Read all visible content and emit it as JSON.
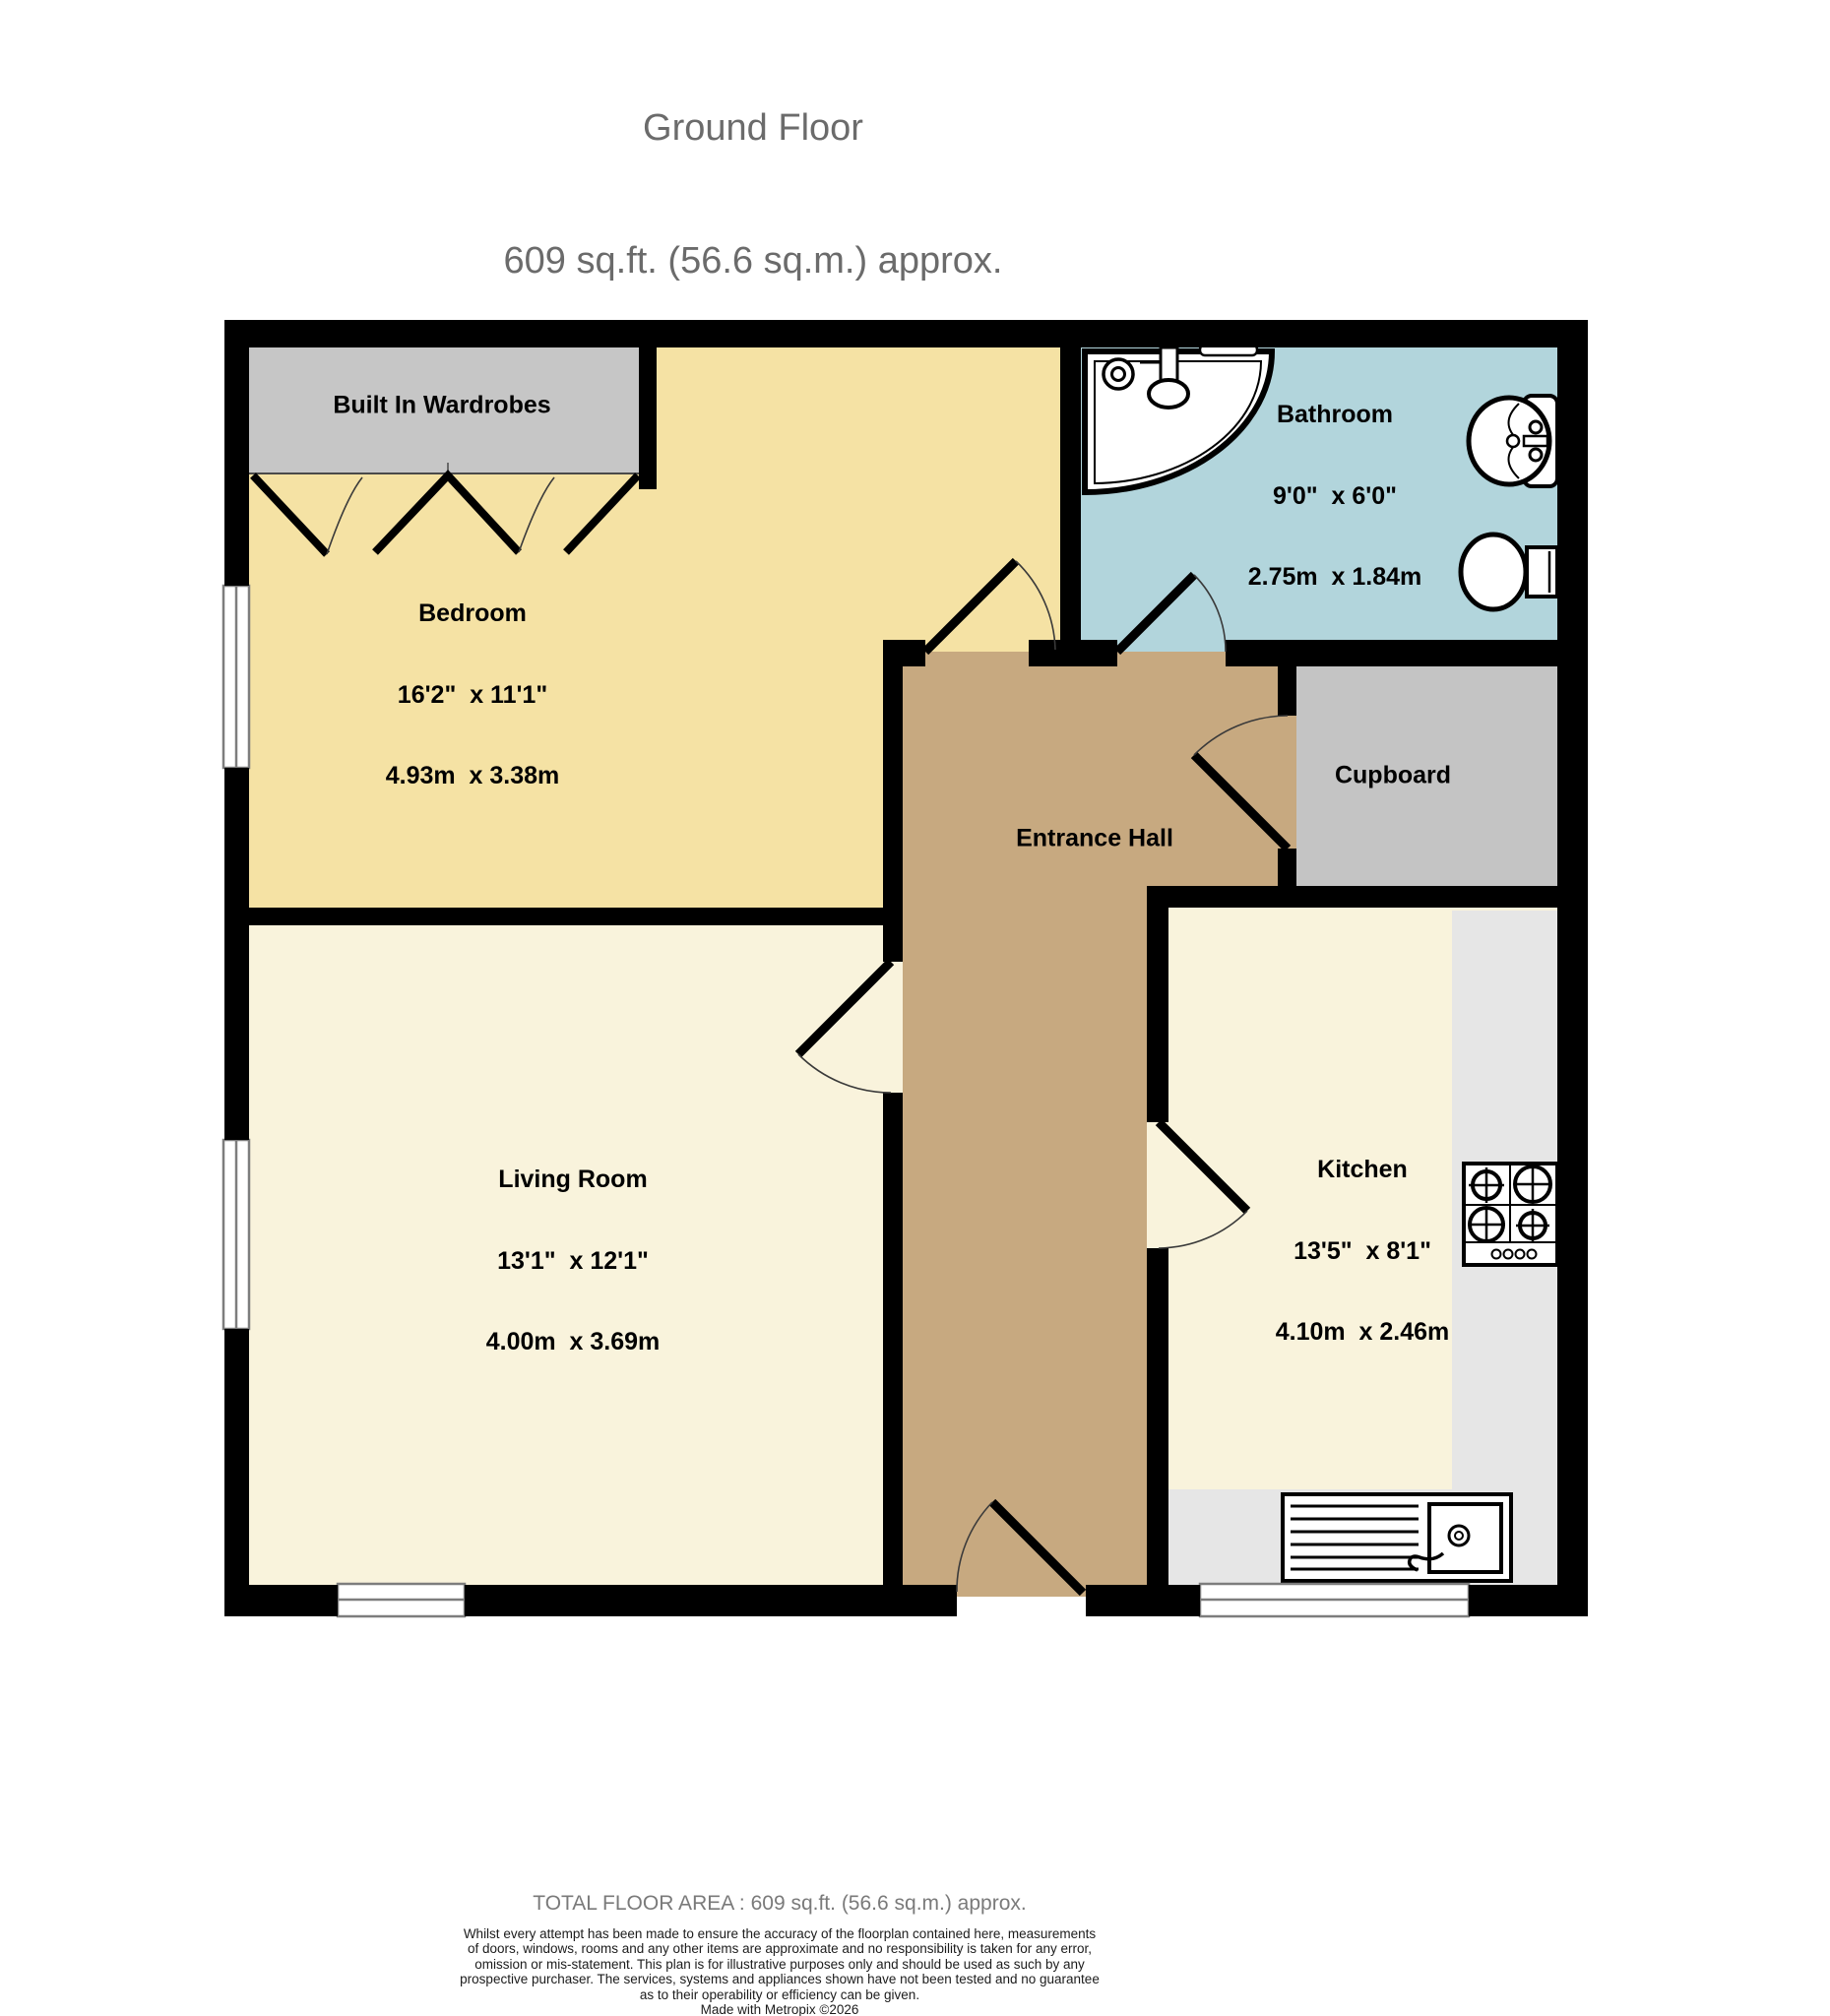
{
  "title": {
    "line1": "Ground Floor",
    "line2": "609 sq.ft. (56.6 sq.m.) approx."
  },
  "rooms": {
    "wardrobe": {
      "name": "Built In Wardrobes"
    },
    "bedroom": {
      "name": "Bedroom",
      "dims_ft": "16'2\"  x 11'1\"",
      "dims_m": "4.93m  x 3.38m"
    },
    "bathroom": {
      "name": "Bathroom",
      "dims_ft": "9'0\"  x 6'0\"",
      "dims_m": "2.75m  x 1.84m"
    },
    "cupboard": {
      "name": "Cupboard"
    },
    "entrance_hall": {
      "name": "Entrance Hall"
    },
    "living_room": {
      "name": "Living Room",
      "dims_ft": "13'1\"  x 12'1\"",
      "dims_m": "4.00m  x 3.69m"
    },
    "kitchen": {
      "name": "Kitchen",
      "dims_ft": "13'5\"  x 8'1\"",
      "dims_m": "4.10m  x 2.46m"
    }
  },
  "footer": {
    "total_area": "TOTAL FLOOR AREA : 609 sq.ft. (56.6 sq.m.) approx.",
    "disclaimer_lines": [
      "Whilst every attempt has been made to ensure the accuracy of the floorplan contained here, measurements",
      "of doors, windows, rooms and any other items are approximate and no responsibility is taken for any error,",
      "omission or mis-statement. This plan is for illustrative purposes only and should be used as such by any",
      "prospective purchaser. The services, systems and appliances shown have not been tested and no guarantee",
      "as to their operability or efficiency can be given."
    ],
    "credit": "Made with Metropix ©2026"
  },
  "colors": {
    "wall": "#000000",
    "bedroom": "#F5E2A4",
    "living_room": "#F9F3DC",
    "kitchen": "#F9F3DC",
    "hall": "#C7A980",
    "bathroom": "#B2D5DC",
    "cupboard": "#C4C4C4",
    "wardrobe": "#C6C6C6",
    "counter": "#E6E6E6",
    "window_frame": "#7d7d7d"
  }
}
